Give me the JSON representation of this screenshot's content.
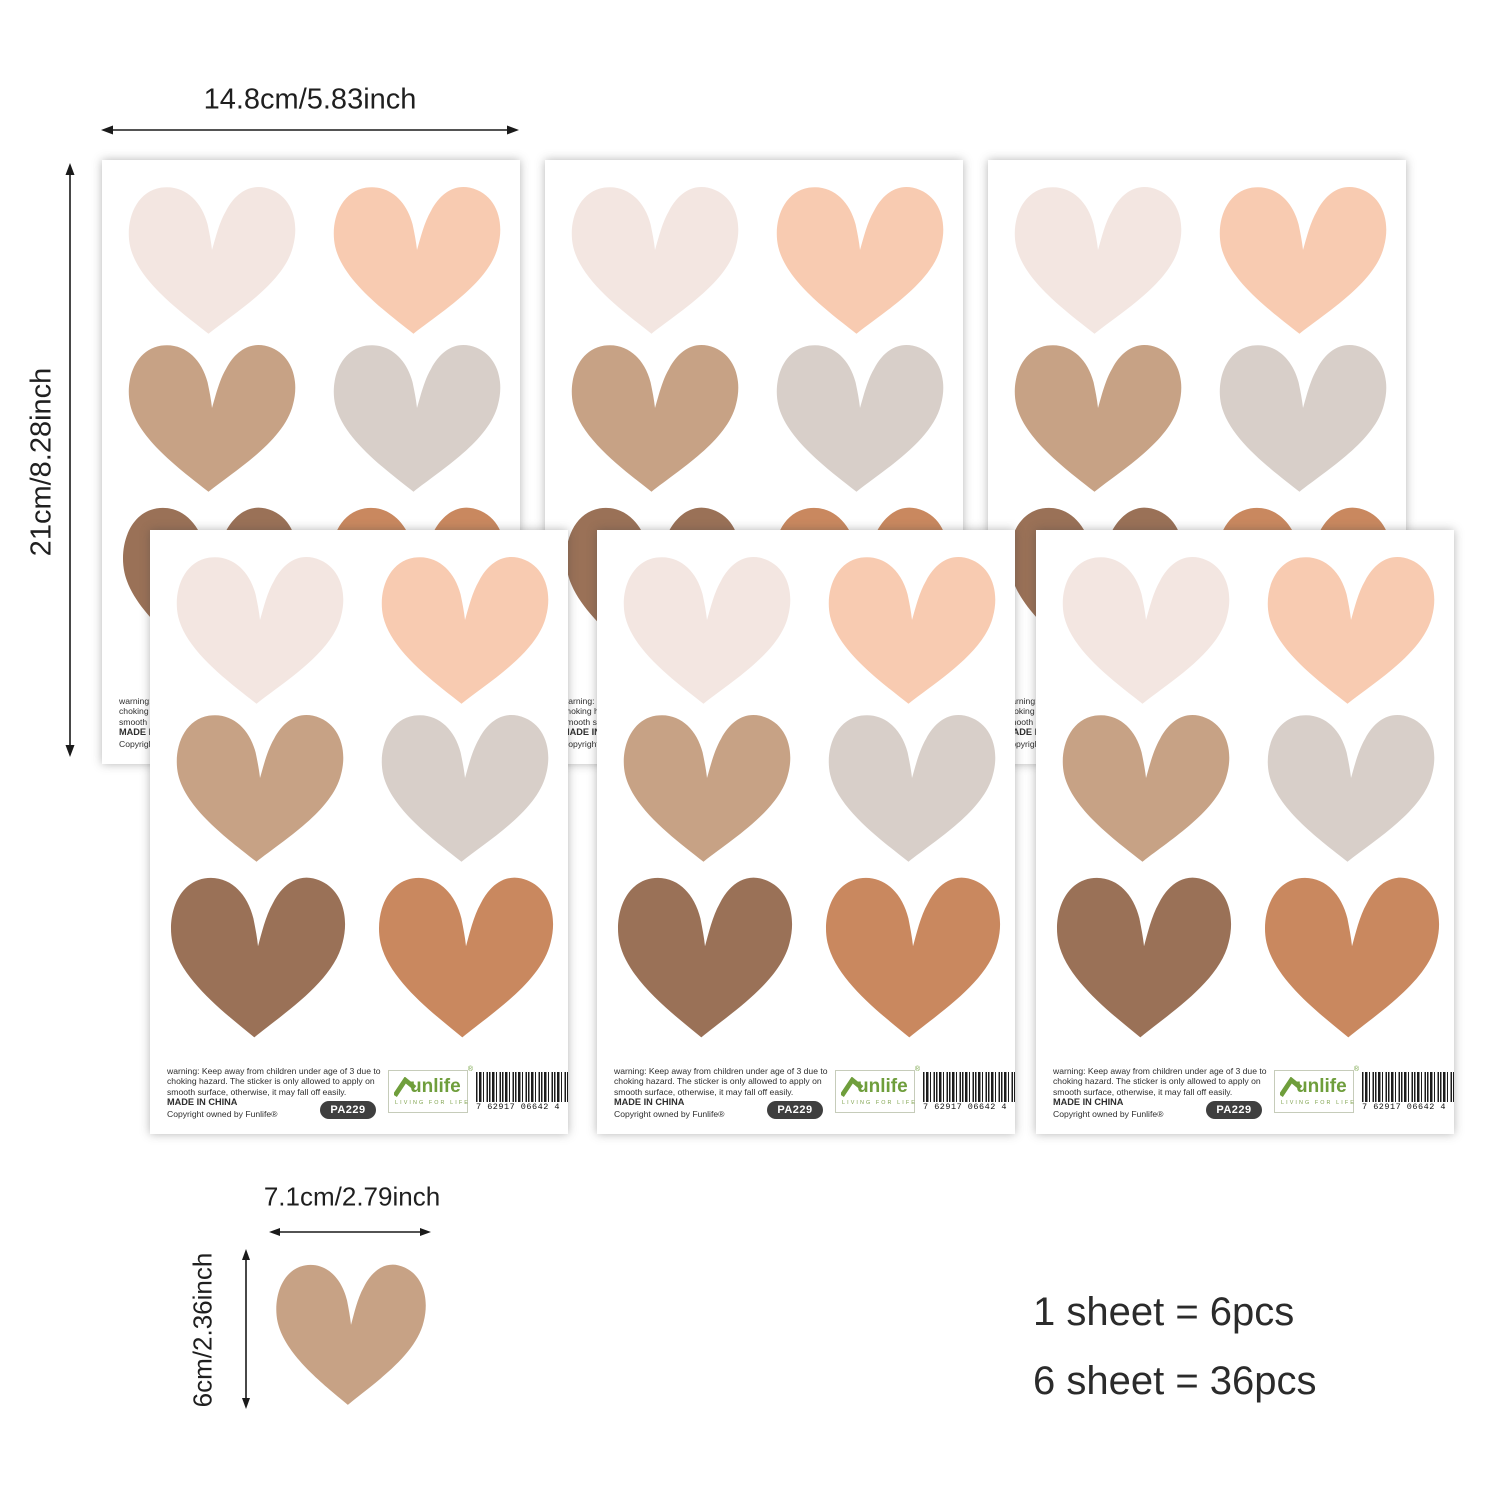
{
  "dimensions": {
    "sheet_width": "14.8cm/5.83inch",
    "sheet_height": "21cm/8.28inch",
    "heart_width": "7.1cm/2.79inch",
    "heart_height": "6cm/2.36inch"
  },
  "pack": {
    "line1": "1 sheet = 6pcs",
    "line2": "6 sheet = 36pcs"
  },
  "sheet": {
    "warning": "warning: Keep away from children under age of 3 due to choking hazard. The sticker is only allowed to apply on smooth surface, otherwise, it may fall off easily.",
    "made_in": "MADE IN CHINA",
    "copyright": "Copyright owned by Funlife®",
    "sku": "PA229",
    "brand_text": "unlife",
    "brand_reg": "®",
    "brand_tagline": "LIVING FOR LIFE",
    "barcode_digits": "7 62917 06642 4"
  },
  "palette": {
    "cream": "#f3e6e1",
    "peach": "#f8cbb1",
    "tan": "#c7a285",
    "greige": "#d8cfc9",
    "brown": "#9a7157",
    "terracotta": "#c9885f",
    "logo_green": "#6f9e3c",
    "arrow": "#1a1a1a",
    "badge_bg": "#3f3f3f"
  },
  "heart_order": [
    "cream",
    "peach",
    "tan",
    "greige",
    "brown",
    "terracotta"
  ]
}
